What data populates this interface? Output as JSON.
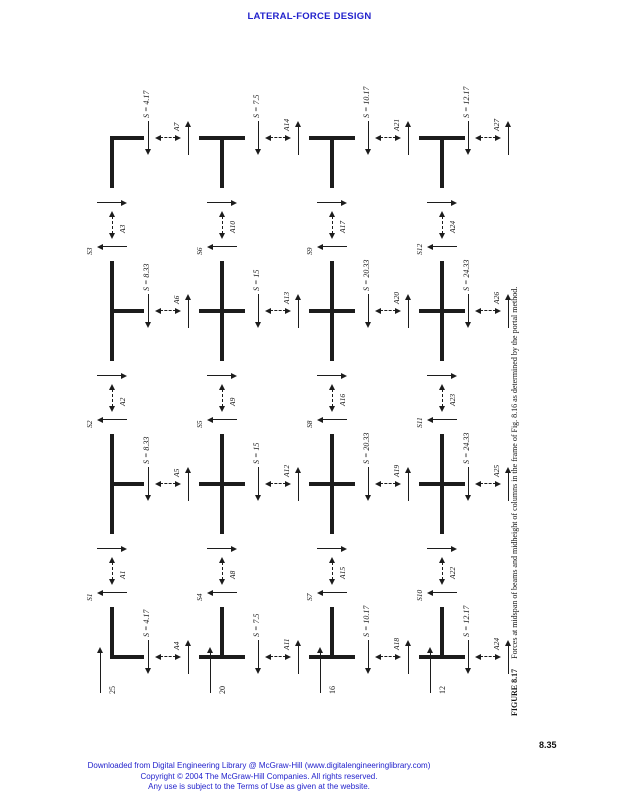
{
  "header": {
    "title": "LATERAL-FORCE DESIGN",
    "color": "#2222cc"
  },
  "page_number": "8.35",
  "figure": {
    "caption_label": "FIGURE 8.17",
    "caption_text": "Forces at midspan of beams and midheight of columns in the frame of Fig. 8.16 as determined by the portal method.",
    "ink_color": "#1c1c1c",
    "story_loads": [
      {
        "level": 1,
        "label": "25"
      },
      {
        "level": 2,
        "label": "20"
      },
      {
        "level": 3,
        "label": "16"
      },
      {
        "level": 4,
        "label": "12"
      }
    ],
    "column_cuts": [
      {
        "col": 1,
        "story": 1,
        "shear": "S = 4.17",
        "axial": "A4"
      },
      {
        "col": 1,
        "story": 2,
        "shear": "S = 7.5",
        "axial": "A11"
      },
      {
        "col": 1,
        "story": 3,
        "shear": "S = 10.17",
        "axial": "A18"
      },
      {
        "col": 1,
        "story": 4,
        "shear": "S = 12.17",
        "axial": "A24"
      },
      {
        "col": 2,
        "story": 1,
        "shear": "S = 8.33",
        "axial": "A5"
      },
      {
        "col": 2,
        "story": 2,
        "shear": "S = 15",
        "axial": "A12"
      },
      {
        "col": 2,
        "story": 3,
        "shear": "S = 20.33",
        "axial": "A19"
      },
      {
        "col": 2,
        "story": 4,
        "shear": "S = 24.33",
        "axial": "A25"
      },
      {
        "col": 3,
        "story": 1,
        "shear": "S = 8.33",
        "axial": "A6"
      },
      {
        "col": 3,
        "story": 2,
        "shear": "S = 15",
        "axial": "A13"
      },
      {
        "col": 3,
        "story": 3,
        "shear": "S = 20.33",
        "axial": "A20"
      },
      {
        "col": 3,
        "story": 4,
        "shear": "S = 24.33",
        "axial": "A26"
      },
      {
        "col": 4,
        "story": 1,
        "shear": "S = 4.17",
        "axial": "A7"
      },
      {
        "col": 4,
        "story": 2,
        "shear": "S = 7.5",
        "axial": "A14"
      },
      {
        "col": 4,
        "story": 3,
        "shear": "S = 10.17",
        "axial": "A21"
      },
      {
        "col": 4,
        "story": 4,
        "shear": "S = 12.17",
        "axial": "A27"
      }
    ],
    "beam_cuts": [
      {
        "bay": 1,
        "level": 1,
        "shear": "S1",
        "axial": "A1"
      },
      {
        "bay": 1,
        "level": 2,
        "shear": "S4",
        "axial": "A8"
      },
      {
        "bay": 1,
        "level": 3,
        "shear": "S7",
        "axial": "A15"
      },
      {
        "bay": 1,
        "level": 4,
        "shear": "S10",
        "axial": "A22"
      },
      {
        "bay": 2,
        "level": 1,
        "shear": "S2",
        "axial": "A2"
      },
      {
        "bay": 2,
        "level": 2,
        "shear": "S5",
        "axial": "A9"
      },
      {
        "bay": 2,
        "level": 3,
        "shear": "S8",
        "axial": "A16"
      },
      {
        "bay": 2,
        "level": 4,
        "shear": "S11",
        "axial": "A23"
      },
      {
        "bay": 3,
        "level": 1,
        "shear": "S3",
        "axial": "A3"
      },
      {
        "bay": 3,
        "level": 2,
        "shear": "S6",
        "axial": "A10"
      },
      {
        "bay": 3,
        "level": 3,
        "shear": "S9",
        "axial": "A17"
      },
      {
        "bay": 3,
        "level": 4,
        "shear": "S12",
        "axial": "A24"
      }
    ]
  },
  "footer": {
    "color": "#2222cc",
    "lines": [
      "Downloaded from Digital Engineering Library @ McGraw-Hill (www.digitalengineeringlibrary.com)",
      "Copyright © 2004 The McGraw-Hill Companies. All rights reserved.",
      "Any use is subject to the Terms of Use as given at the website."
    ]
  }
}
